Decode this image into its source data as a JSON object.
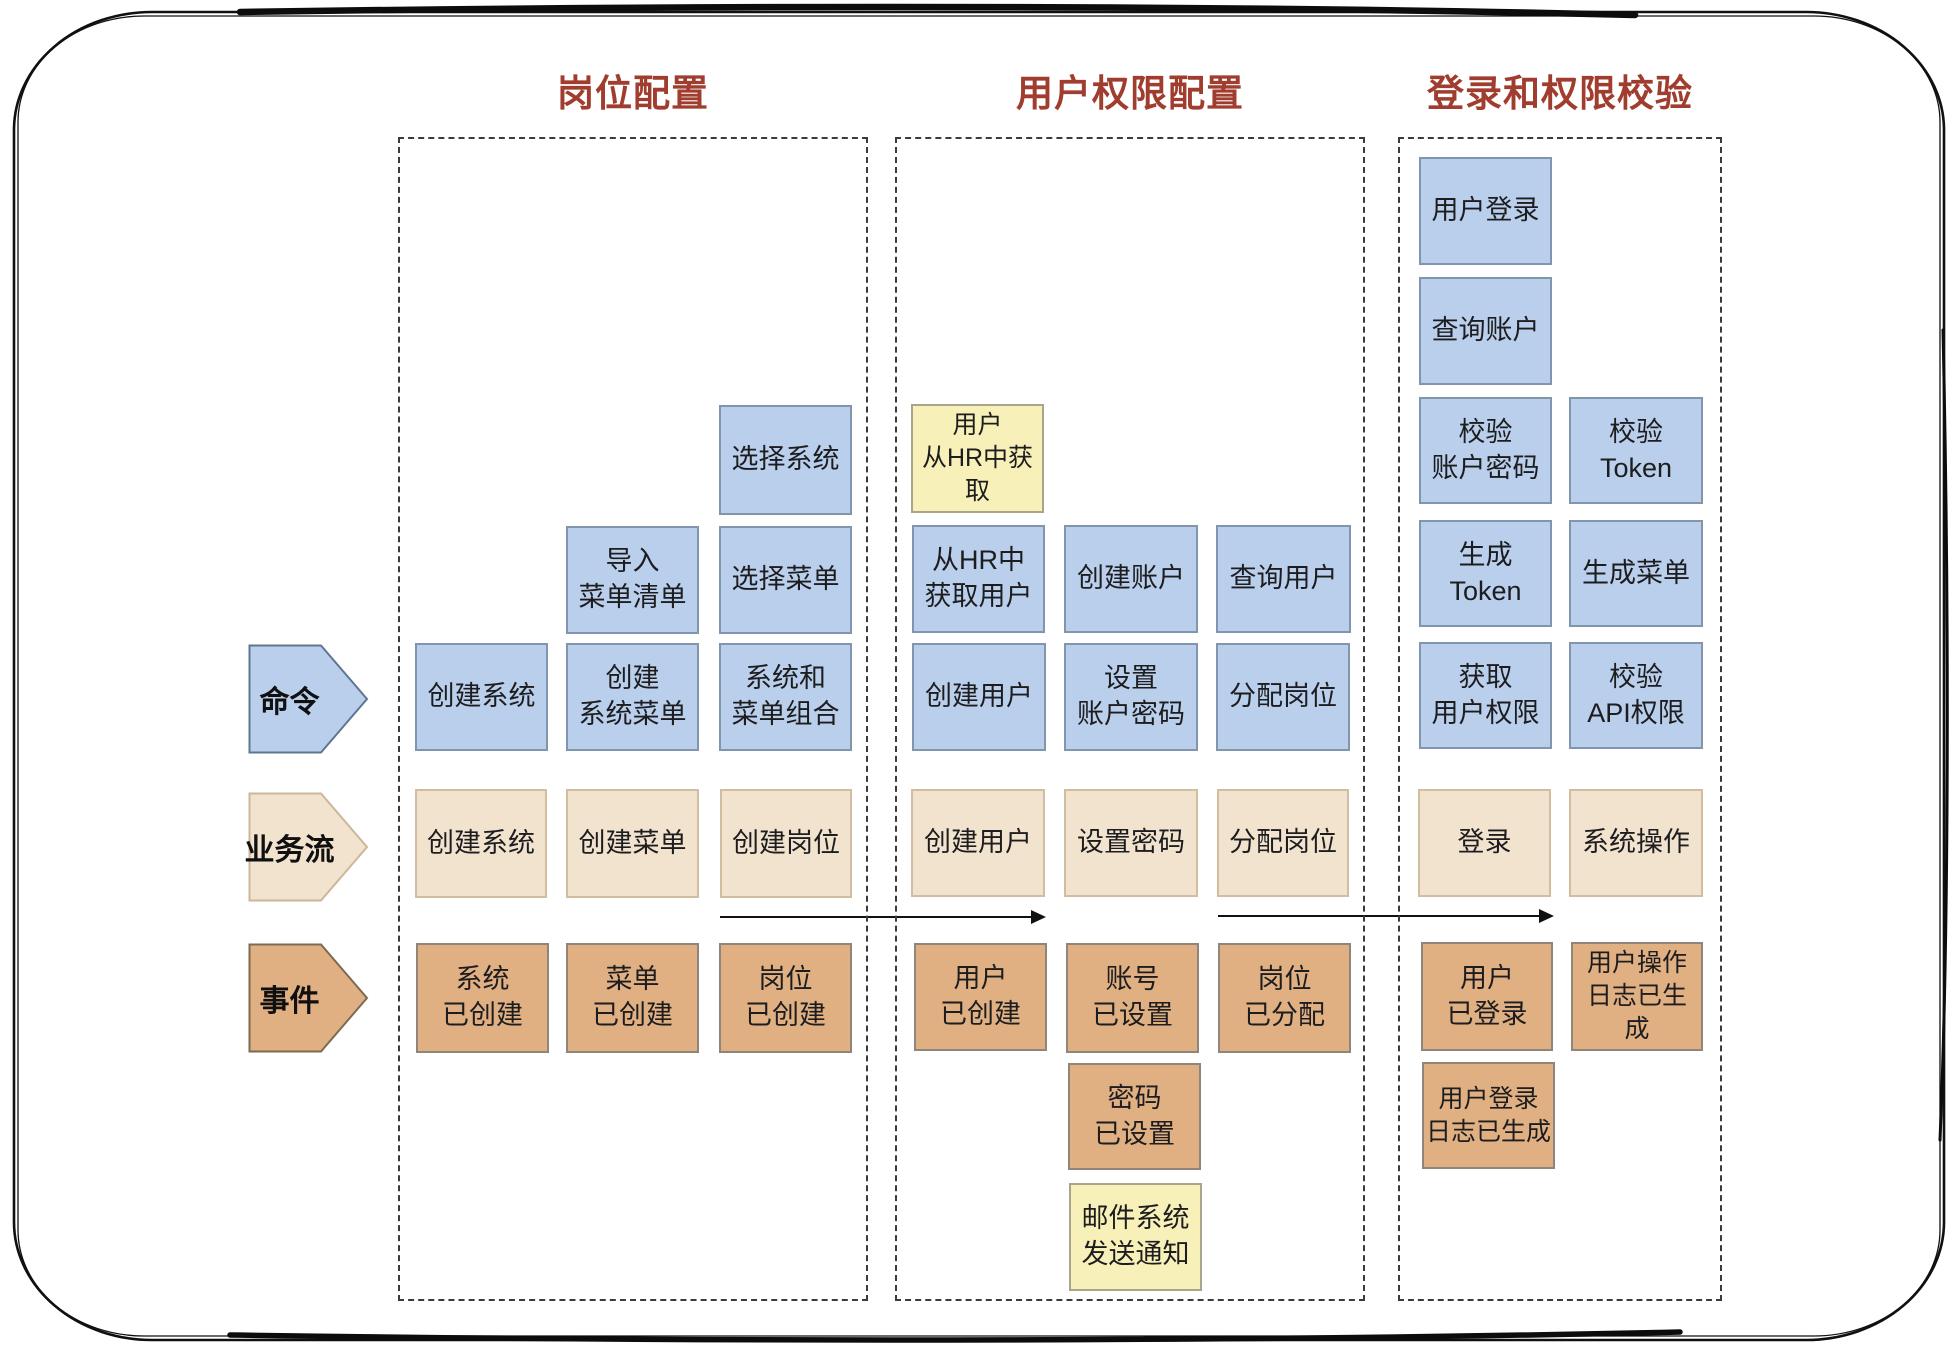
{
  "diagram_title": "事件风暴图：岗位 / 用户权限 / 登录校验",
  "palette": {
    "command_blue": "#b9cfec",
    "business_flow_tan": "#f2e3cf",
    "event_orange": "#e0b083",
    "external_yellow": "#f7f0b8",
    "section_title_red": "#a03d2e"
  },
  "sections": [
    {
      "title": "岗位配置"
    },
    {
      "title": "用户权限配置"
    },
    {
      "title": "登录和权限校验"
    }
  ],
  "row_labels": {
    "command": "命令",
    "flow": "业务流",
    "event": "事件"
  },
  "boxes": {
    "c1_select_system": "选择系统",
    "c1_import_menu_list": "导入\n菜单清单",
    "c1_select_menu": "选择菜单",
    "c1_create_system_cmd": "创建系统",
    "c1_create_system_menu": "创建\n系统菜单",
    "c1_system_menu_combo": "系统和\n菜单组合",
    "c1_flow_create_system": "创建系统",
    "c1_flow_create_menu": "创建菜单",
    "c1_flow_create_post": "创建岗位",
    "c1_evt_system_created": "系统\n已创建",
    "c1_evt_menu_created": "菜单\n已创建",
    "c1_evt_post_created": "岗位\n已创建",
    "c2_ext_user_from_hr": "用户\n从HR中获取",
    "c2_get_user_from_hr": "从HR中\n获取用户",
    "c2_create_account": "创建账户",
    "c2_query_user": "查询用户",
    "c2_create_user_cmd": "创建用户",
    "c2_set_account_password": "设置\n账户密码",
    "c2_assign_post_cmd": "分配岗位",
    "c2_flow_create_user": "创建用户",
    "c2_flow_set_password": "设置密码",
    "c2_flow_assign_post": "分配岗位",
    "c2_evt_user_created": "用户\n已创建",
    "c2_evt_account_set": "账号\n已设置",
    "c2_evt_post_assigned": "岗位\n已分配",
    "c2_evt_password_set": "密码\n已设置",
    "c2_ext_mail_notify": "邮件系统\n发送通知",
    "c3_user_login": "用户登录",
    "c3_query_account": "查询账户",
    "c3_verify_account_password": "校验\n账户密码",
    "c3_verify_token": "校验\nToken",
    "c3_generate_token": "生成\nToken",
    "c3_generate_menu": "生成菜单",
    "c3_get_user_permissions": "获取\n用户权限",
    "c3_verify_api_permission": "校验\nAPI权限",
    "c3_flow_login": "登录",
    "c3_flow_system_operation": "系统操作",
    "c3_evt_user_logged_in": "用户\n已登录",
    "c3_evt_operation_log_generated": "用户操作\n日志已生成",
    "c3_evt_login_log_generated": "用户登录\n日志已生成"
  }
}
